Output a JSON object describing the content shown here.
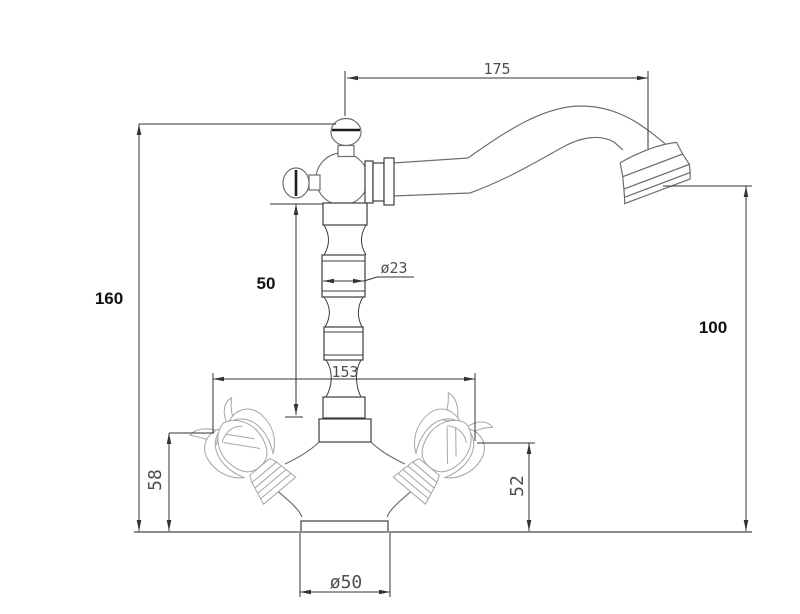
{
  "drawing": {
    "subject": "classic two-handle single-hole basin faucet, side elevation technical drawing",
    "units": "mm",
    "colors": {
      "dimension_lines": "#333333",
      "artwork_outline": "#6f6f6f",
      "mounting_surface": "#8c8c8c",
      "bold_text": "#101010",
      "cad_text": "#4f4f4f"
    },
    "dimensions": {
      "spout_reach": "175",
      "overall_height": "160",
      "outlet_height": "100",
      "upper_body_height": "50",
      "column_diameter": "ø23",
      "handle_span": "153",
      "left_handle_height": "58",
      "right_handle_height": "52",
      "base_diameter": "ø50"
    }
  }
}
